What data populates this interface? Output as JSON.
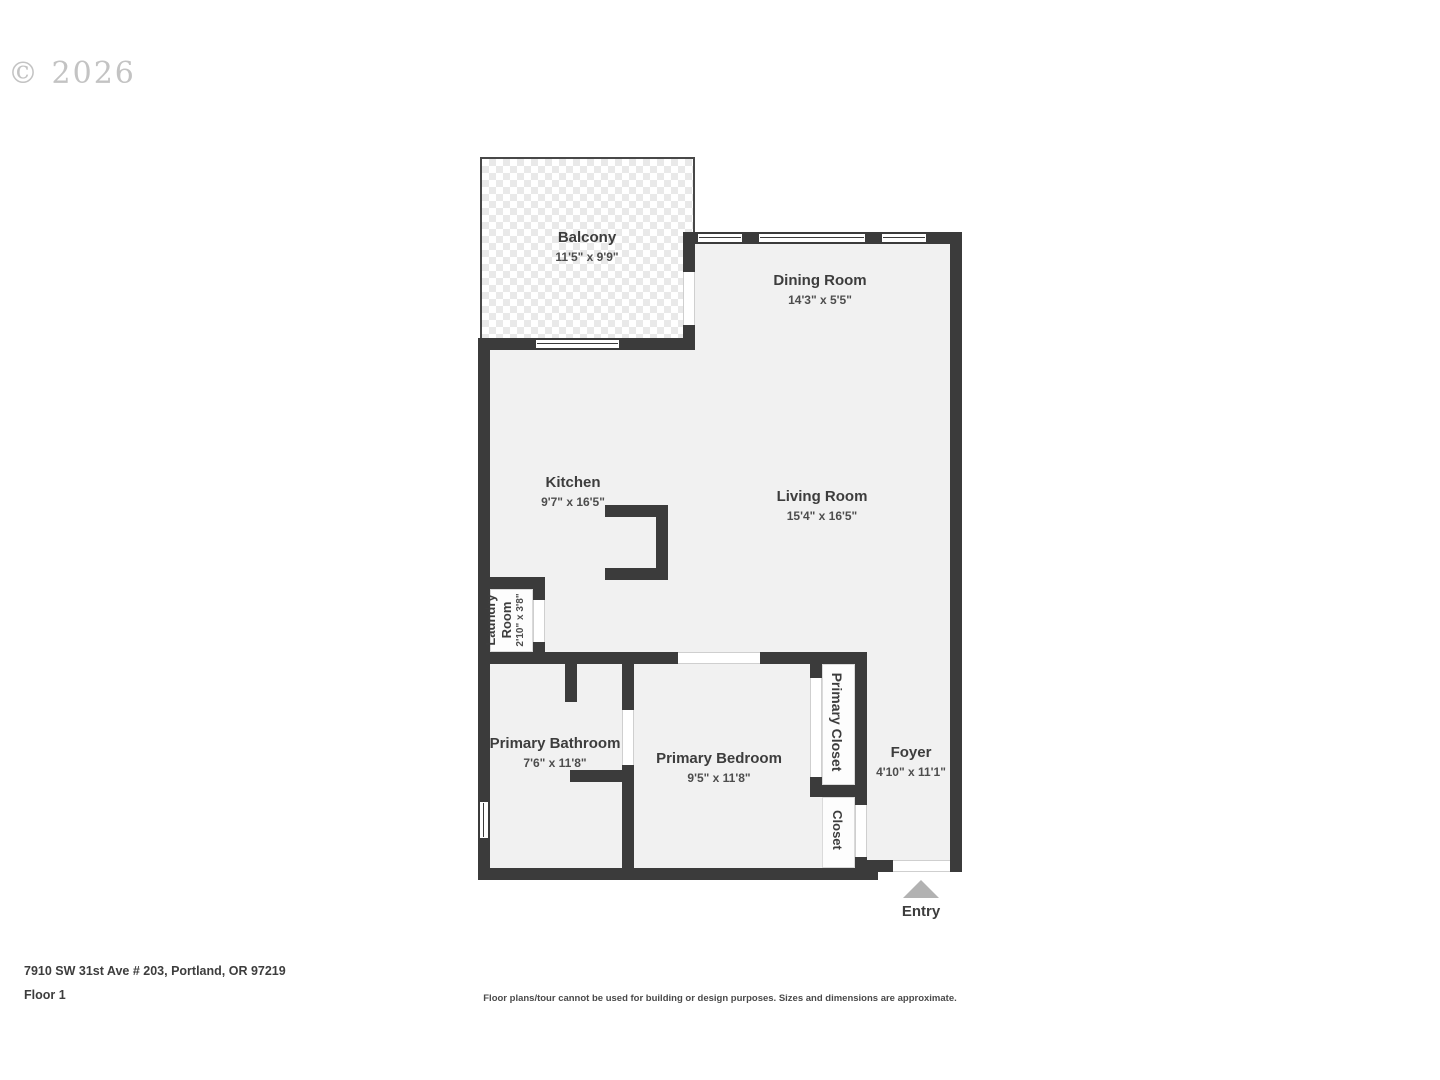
{
  "watermark": "© 2026",
  "rooms": {
    "balcony": {
      "name": "Balcony",
      "dims": "11'5\" x 9'9\""
    },
    "dining": {
      "name": "Dining Room",
      "dims": "14'3\" x 5'5\""
    },
    "kitchen": {
      "name": "Kitchen",
      "dims": "9'7\" x 16'5\""
    },
    "living": {
      "name": "Living Room",
      "dims": "15'4\" x 16'5\""
    },
    "laundry": {
      "name": "Laundry Room",
      "dims": "2'10\" x 3'8\""
    },
    "bathroom": {
      "name": "Primary Bathroom",
      "dims": "7'6\" x 11'8\""
    },
    "bedroom": {
      "name": "Primary Bedroom",
      "dims": "9'5\" x 11'8\""
    },
    "primary_closet": {
      "name": "Primary Closet"
    },
    "closet": {
      "name": "Closet"
    },
    "foyer": {
      "name": "Foyer",
      "dims": "4'10\" x 11'1\""
    }
  },
  "entry_label": "Entry",
  "footer": {
    "address": "7910 SW 31st Ave # 203, Portland, OR 97219",
    "floor": "Floor 1",
    "disclaimer": "Floor plans/tour cannot be used for building or design purposes. Sizes and dimensions are approximate."
  },
  "colors": {
    "wall": "#3b3b3b",
    "room_fill": "#f1f1f1",
    "closet_fill": "#fdfdfd",
    "text": "#3d3d3d",
    "entry_arrow": "#b2b2b2",
    "watermark": "#c3c3c3"
  }
}
